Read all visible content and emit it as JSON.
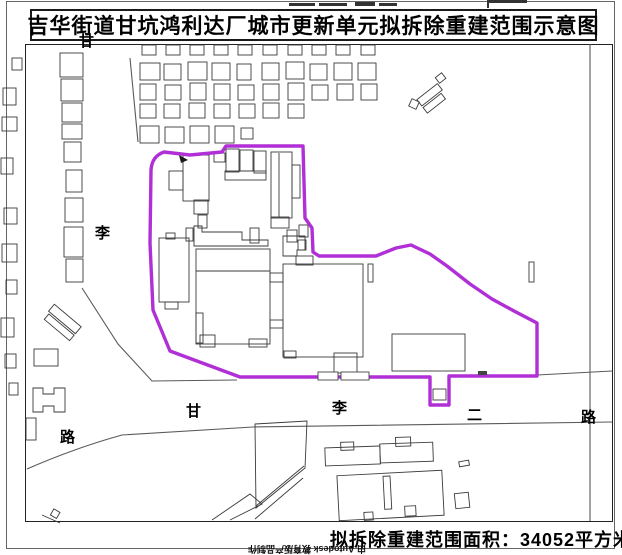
{
  "title": "吉华街道甘坑鸿利达厂城市更新单元拟拆除重建范围示意图",
  "area_label": "拟拆除重建范围面积：34052平方米",
  "watermark": "由 Autodesk 教育版产品制作",
  "boundary_color": "#b02fd6",
  "roads": {
    "left_labels": [
      "甘",
      "李",
      "路"
    ],
    "bottom_labels": [
      "甘",
      "李",
      "二",
      "路"
    ]
  }
}
